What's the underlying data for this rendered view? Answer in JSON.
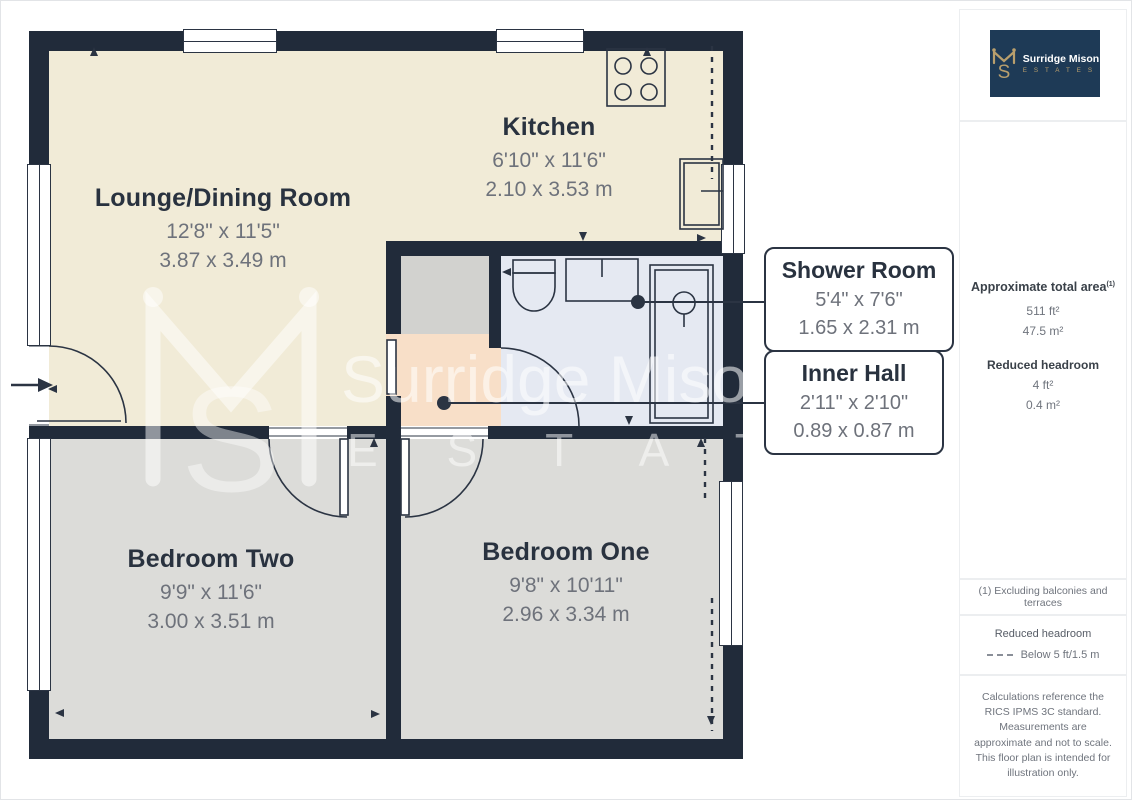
{
  "rooms": {
    "lounge": {
      "name": "Lounge/Dining Room",
      "imperial": "12'8\" x 11'5\"",
      "metric": "3.87 x 3.49 m"
    },
    "kitchen": {
      "name": "Kitchen",
      "imperial": "6'10\" x 11'6\"",
      "metric": "2.10 x 3.53 m"
    },
    "bedroom_two": {
      "name": "Bedroom Two",
      "imperial": "9'9\" x 11'6\"",
      "metric": "3.00 x 3.51 m"
    },
    "bedroom_one": {
      "name": "Bedroom One",
      "imperial": "9'8\" x 10'11\"",
      "metric": "2.96 x 3.34 m"
    }
  },
  "callouts": {
    "shower": {
      "name": "Shower Room",
      "imperial": "5'4\" x 7'6\"",
      "metric": "1.65 x 2.31 m"
    },
    "inner_hall": {
      "name": "Inner Hall",
      "imperial": "2'11\" x 2'10\"",
      "metric": "0.89 x 0.87 m"
    }
  },
  "watermark": {
    "monogram_s": "S",
    "line1": "Surridge Mison",
    "line2": "E S T A T E S"
  },
  "logo": {
    "monogram_s": "S",
    "name": "Surridge Mison",
    "tagline": "E S T A T E S"
  },
  "sidebar": {
    "area_title": "Approximate total area",
    "area_note_ref": "(1)",
    "area_ft": "511 ft²",
    "area_m": "47.5 m²",
    "headroom_title": "Reduced headroom",
    "headroom_ft": "4 ft²",
    "headroom_m": "0.4 m²",
    "note1": "(1) Excluding balconies and terraces",
    "legend_title": "Reduced headroom",
    "legend_label": "Below 5 ft/1.5 m",
    "disclaimer": "Calculations reference the RICS IPMS 3C standard. Measurements are approximate and not to scale. This floor plan is intended for illustration only.",
    "brand": "GIRAFFE",
    "brand_bold": "360"
  },
  "colors": {
    "wall": "#212b3a",
    "lounge_kitchen_floor": "#f1ebd7",
    "bedroom_floor": "#dcdcd9",
    "shower_floor": "#e5e9f2",
    "hall_floor": "#f8dfc8",
    "logo_navy": "#1e3a56",
    "logo_gold": "#b99f6d"
  }
}
